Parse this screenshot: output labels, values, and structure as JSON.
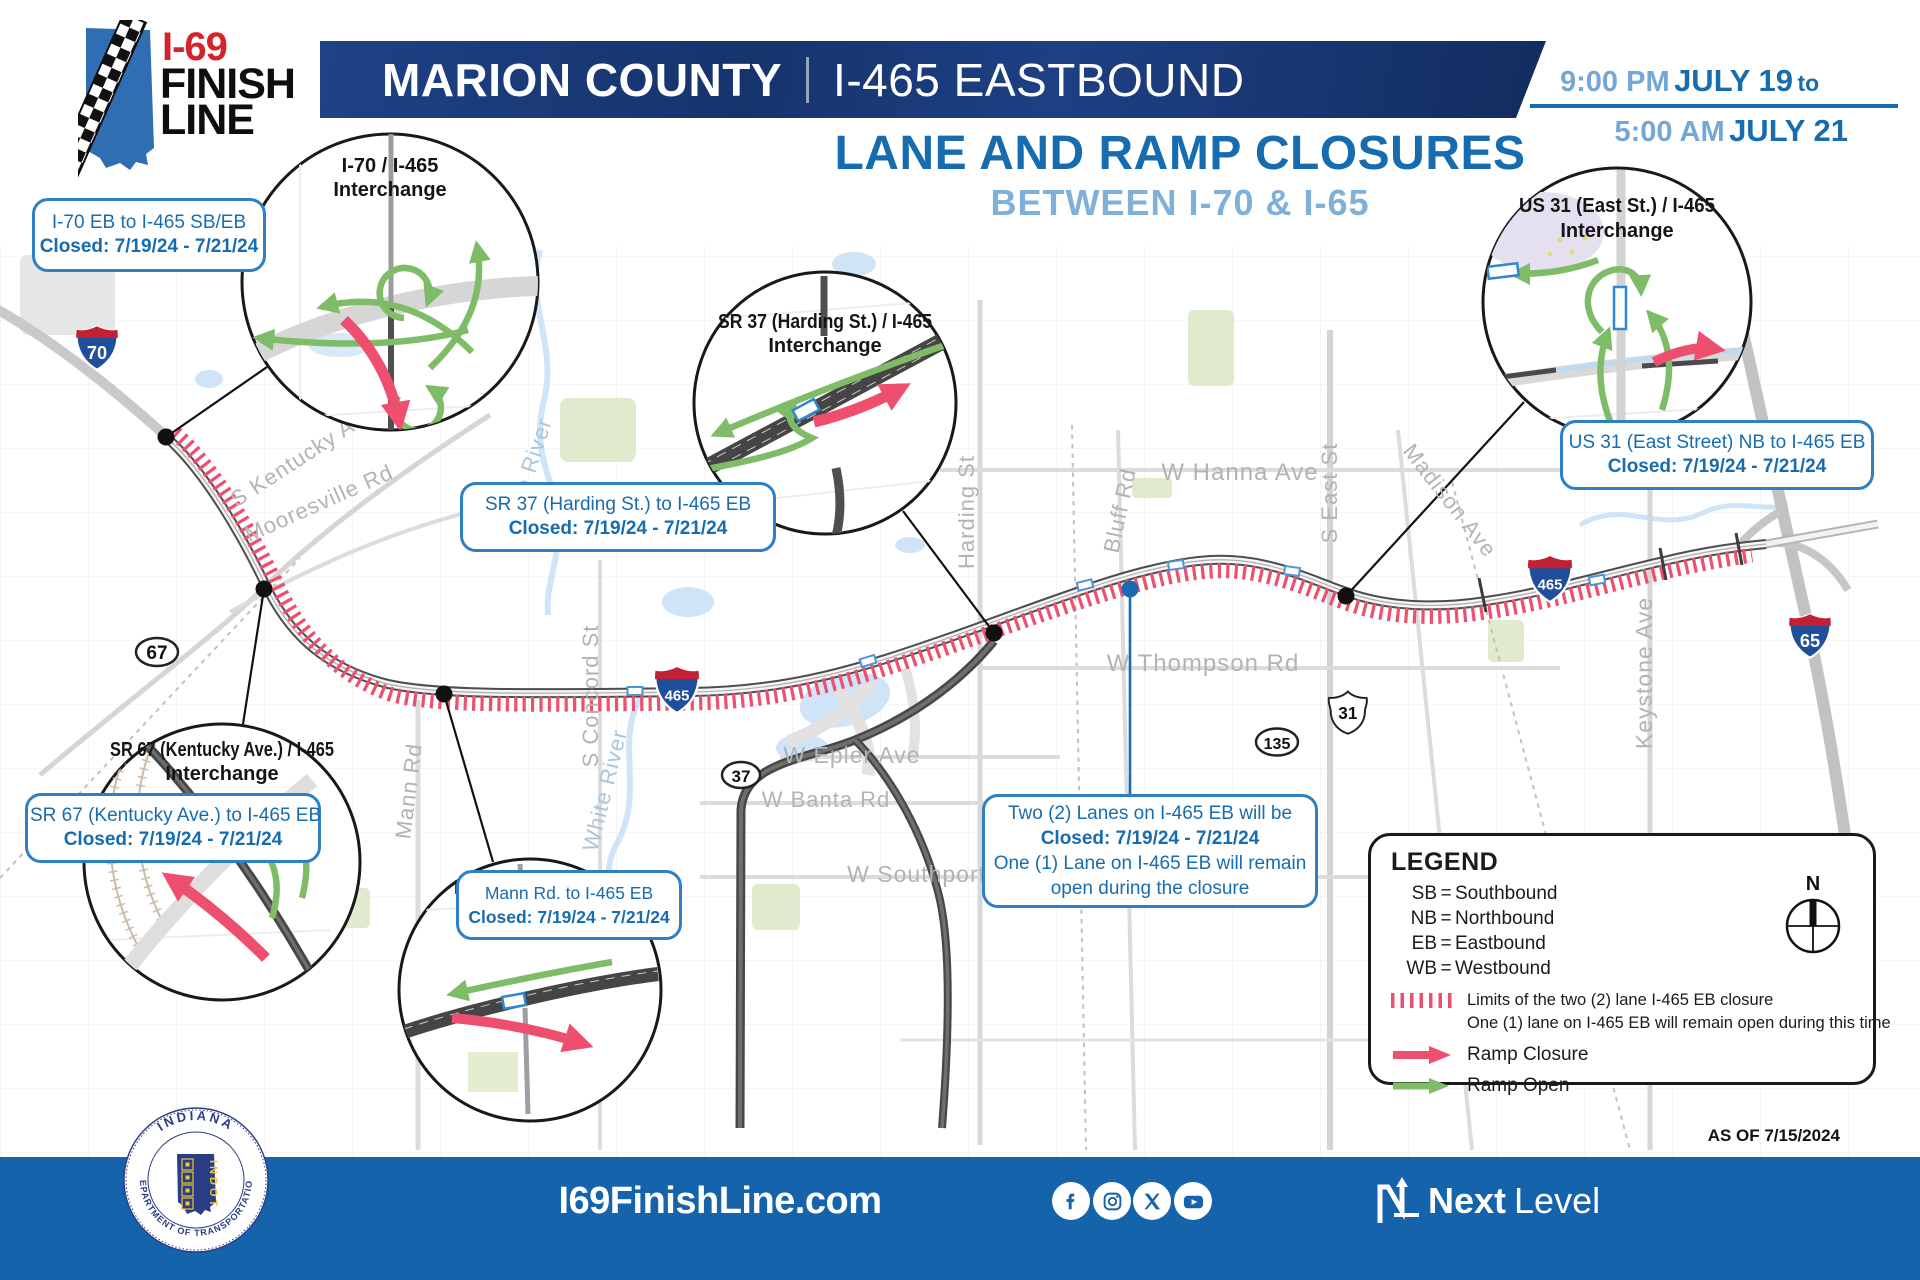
{
  "colors": {
    "banner_blue": "#1c3e7d",
    "accent_blue": "#176cb0",
    "light_blue": "#7fb0da",
    "footer_blue": "#1563ab",
    "closure_pink": "#ee4f6e",
    "open_green": "#7fbc68",
    "logo_red": "#d5232e",
    "shield_blue": "#1f4e9c",
    "shield_red": "#c22033"
  },
  "logo": {
    "route": "I-69",
    "finish": "FINISH",
    "line": "LINE"
  },
  "banner": {
    "county": "MARION COUNTY",
    "route": "I-465 EASTBOUND"
  },
  "schedule": {
    "start_time": "9:00 PM",
    "start_date": "JULY 19",
    "joiner": "to",
    "end_time": "5:00 AM",
    "end_date": "JULY 21"
  },
  "title": {
    "main": "LANE AND RAMP CLOSURES",
    "sub": "BETWEEN I-70 & I-65"
  },
  "interchanges": [
    {
      "name": "I-70 / I-465",
      "label": "Interchange"
    },
    {
      "name": "SR 37 (Harding St.) / I-465",
      "label": "Interchange"
    },
    {
      "name": "US 31 (East St.) / I-465",
      "label": "Interchange"
    },
    {
      "name": "SR 67 (Kentucky Ave.) / I-465",
      "label": "Interchange"
    },
    {
      "name": "Mann Rd. / I-465",
      "label": "Interchange"
    }
  ],
  "closures": [
    {
      "ramp": "I-70 EB to I-465 SB/EB",
      "dates": "Closed: 7/19/24 - 7/21/24"
    },
    {
      "ramp": "SR 37 (Harding St.) to I-465 EB",
      "dates": "Closed: 7/19/24 - 7/21/24"
    },
    {
      "ramp": "US 31 (East Street) NB to I-465 EB",
      "dates": "Closed: 7/19/24 - 7/21/24"
    },
    {
      "ramp": "SR 67 (Kentucky Ave.) to I-465 EB",
      "dates": "Closed: 7/19/24 - 7/21/24"
    },
    {
      "ramp": "Mann Rd. to I-465 EB",
      "dates": "Closed: 7/19/24 - 7/21/24"
    }
  ],
  "lane_closure_note": {
    "line1": "Two (2) Lanes on I-465 EB will be",
    "line2": "Closed: 7/19/24 - 7/21/24",
    "line3": "One (1) Lane on I-465 EB will remain",
    "line4": "open during the closure"
  },
  "legend": {
    "title": "LEGEND",
    "abbreviations": [
      {
        "key": "SB",
        "value": "Southbound"
      },
      {
        "key": "NB",
        "value": "Northbound"
      },
      {
        "key": "EB",
        "value": "Eastbound"
      },
      {
        "key": "WB",
        "value": "Westbound"
      }
    ],
    "limits_line1": "Limits of the two (2) lane I-465 EB closure",
    "limits_line2": "One (1) lane on I-465 EB will remain open during this time",
    "ramp_closure": "Ramp Closure",
    "ramp_open": "Ramp Open",
    "compass_north": "N"
  },
  "as_of": "AS OF 7/15/2024",
  "shields": {
    "i70": "70",
    "i65": "65",
    "i465": "465",
    "us31": "31",
    "sr67": "67",
    "sr135": "135",
    "sr37": "37"
  },
  "map_labels": {
    "kentucky_ave": "S Kentucky Ave",
    "mooresville_rd": "Mooresville Rd",
    "white_river_n": "White River",
    "white_river_s": "White River",
    "harding_st": "Harding St",
    "bluff_rd": "Bluff Rd",
    "hanna_ave": "W Hanna Ave",
    "east_st": "S East St",
    "madison_ave": "Madison Ave",
    "thompson_rd": "W Thompson Rd",
    "epler_ave": "W Epler Ave",
    "concord_st": "S Concord St",
    "mann_rd": "Mann Rd",
    "banta_rd": "W Banta Rd",
    "southport_rd": "W Southport Rd",
    "keystone_ave": "Keystone Ave"
  },
  "footer": {
    "website": "I69FinishLine.com",
    "social_icons": [
      "facebook",
      "instagram",
      "x",
      "youtube"
    ],
    "brand_bold": "Next",
    "brand_light": "Level"
  },
  "seal": {
    "arc_top": "INDIANA",
    "arc_bottom": "DEPARTMENT OF TRANSPORTATION",
    "acronym": "INDOT"
  }
}
